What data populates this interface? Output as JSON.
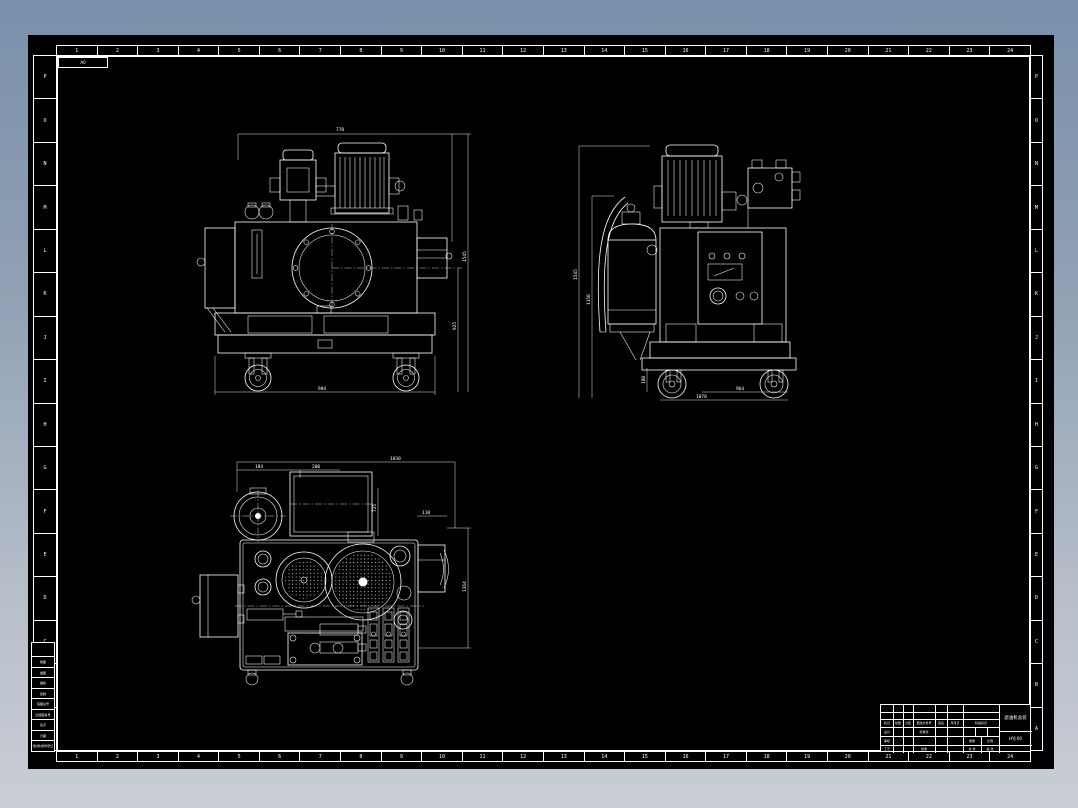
{
  "sheet": {
    "size_label": "A0",
    "top_numbers": [
      "1",
      "2",
      "3",
      "4",
      "5",
      "6",
      "7",
      "8",
      "9",
      "10",
      "11",
      "12",
      "13",
      "14",
      "15",
      "16",
      "17",
      "18",
      "19",
      "20",
      "21",
      "22",
      "23",
      "24"
    ],
    "bottom_numbers": [
      "1",
      "2",
      "3",
      "4",
      "5",
      "6",
      "7",
      "8",
      "9",
      "10",
      "11",
      "12",
      "13",
      "14",
      "15",
      "16",
      "17",
      "18",
      "19",
      "20",
      "21",
      "22",
      "23",
      "24"
    ],
    "left_letters": [
      "P",
      "O",
      "N",
      "M",
      "L",
      "K",
      "J",
      "I",
      "H",
      "G",
      "F",
      "E",
      "D",
      "C",
      "B",
      "A"
    ],
    "right_letters": [
      "P",
      "O",
      "N",
      "M",
      "L",
      "K",
      "J",
      "I",
      "H",
      "G",
      "F",
      "E",
      "D",
      "C",
      "B",
      "A"
    ],
    "strip_rows": [
      "幅面",
      "描图",
      "描校",
      "复制",
      "底图总号",
      "旧底图总号",
      "签字",
      "日期",
      "借(通)用件登记"
    ],
    "colors": {
      "paper": "#000000",
      "lines": "#ffffff",
      "backdrop_top": "#7a90aa",
      "backdrop_bottom": "#c9ced6"
    }
  },
  "title_block": {
    "rev_header": [
      "标记",
      "处数",
      "分区",
      "更改文件号",
      "签名",
      "年月日"
    ],
    "sig_design": "设计",
    "sig_check": "审核",
    "sig_process": "工艺",
    "sig_standard": "标准化",
    "sig_approve": "批准",
    "stage_label": "阶段标记",
    "weight_label": "重量",
    "scale_label": "比例",
    "sheets_label": "共 张",
    "page_label": "第 张",
    "name": "滤油机总装",
    "code": "HYJ-00"
  },
  "views": {
    "front": {
      "label": "front-view",
      "dims": {
        "top": "770",
        "right_inner": "925",
        "right_outer": "1545",
        "bottom": "904"
      }
    },
    "side": {
      "label": "side-view",
      "dims": {
        "left_outer": "1545",
        "left_inner": "1150",
        "bottom_inner": "964",
        "bottom_outer": "1070",
        "caster": "180"
      }
    },
    "top": {
      "label": "top-view",
      "dims": {
        "width": "1030",
        "seg1": "184",
        "seg2": "200",
        "bracket": "110",
        "right_outer": "1264",
        "inner_v": "725"
      }
    }
  }
}
